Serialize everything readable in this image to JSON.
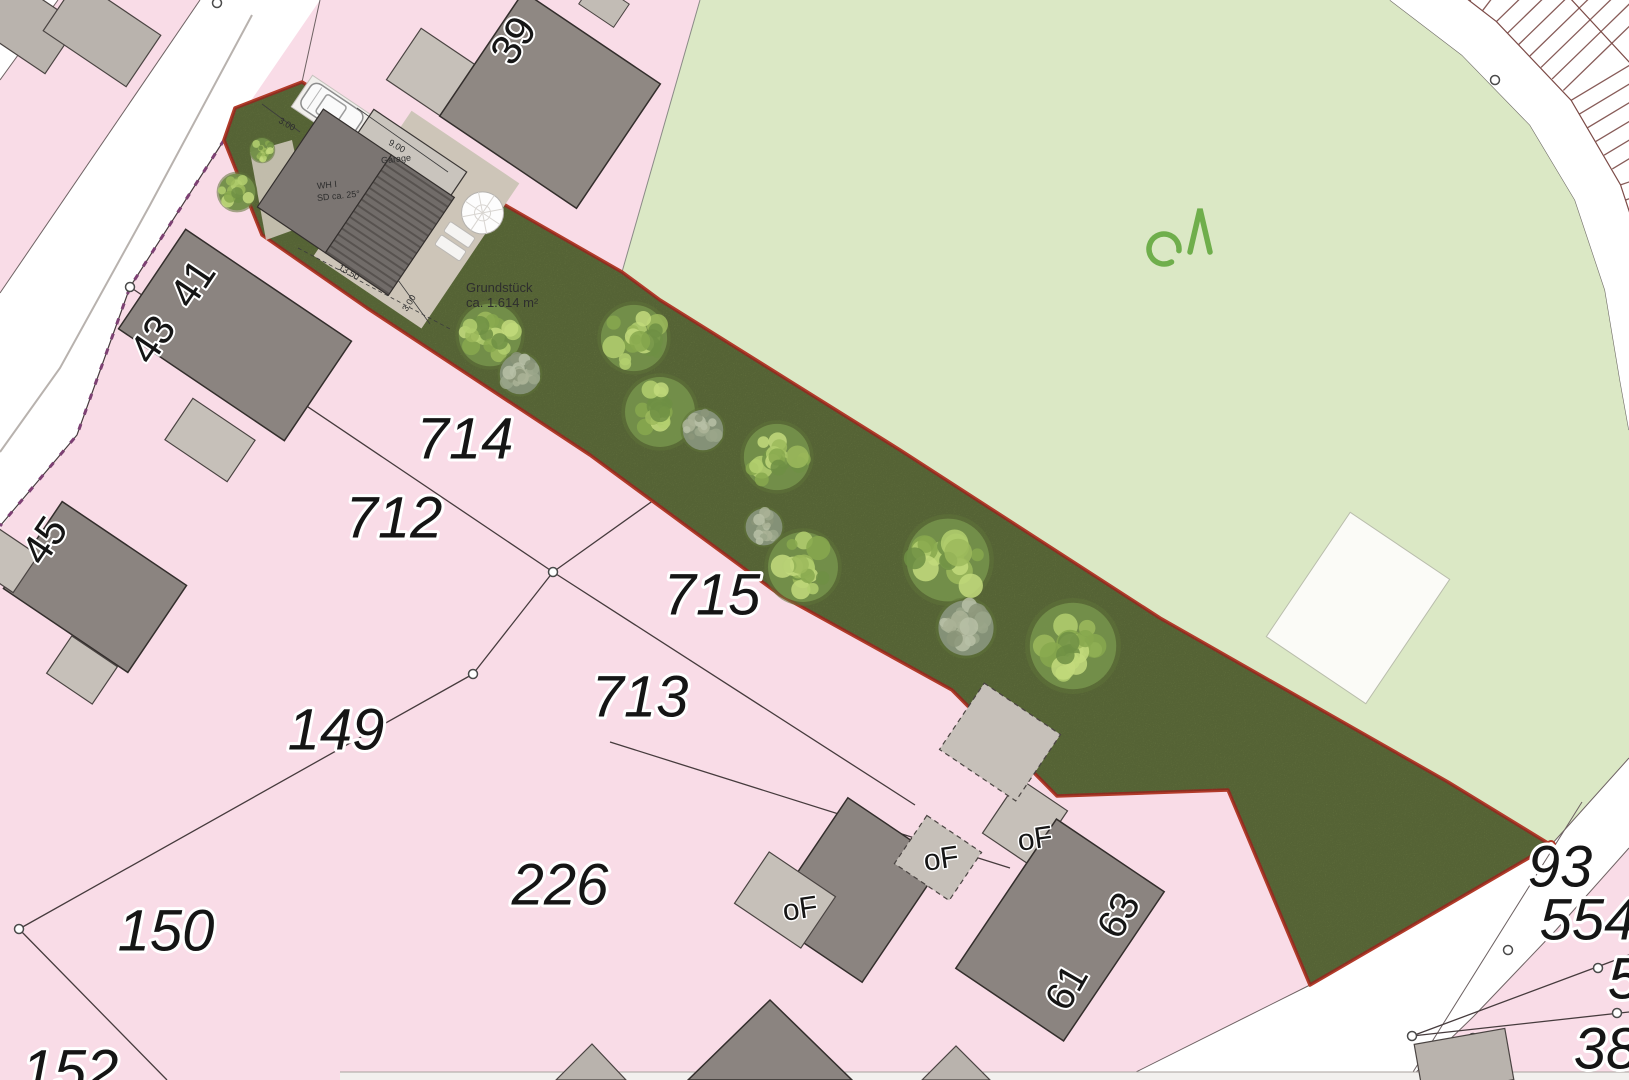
{
  "map": {
    "area_label": {
      "line1": "Grundstück",
      "line2": "ca. 1.614 m²"
    },
    "house_plan": {
      "name": "WH I",
      "roof": "SD ca. 25°",
      "garage": "Garage",
      "dim_garage": "9.00",
      "dim_house": "13.50",
      "dim_parking": "3.00",
      "dim_side": "3.00"
    },
    "vegetation_symbol": "oΛ",
    "labels": [
      {
        "t": "714",
        "x": 465,
        "y": 438,
        "s": 58,
        "r": 0,
        "cls": "parcel"
      },
      {
        "t": "712",
        "x": 394,
        "y": 517,
        "s": 58,
        "r": 0,
        "cls": "parcel"
      },
      {
        "t": "715",
        "x": 712,
        "y": 594,
        "s": 58,
        "r": 0,
        "cls": "parcel"
      },
      {
        "t": "713",
        "x": 640,
        "y": 696,
        "s": 58,
        "r": 0,
        "cls": "parcel"
      },
      {
        "t": "149",
        "x": 336,
        "y": 729,
        "s": 58,
        "r": 0,
        "cls": "parcel"
      },
      {
        "t": "150",
        "x": 166,
        "y": 930,
        "s": 58,
        "r": 0,
        "cls": "parcel"
      },
      {
        "t": "226",
        "x": 560,
        "y": 884,
        "s": 58,
        "r": 0,
        "cls": "parcel"
      },
      {
        "t": "152",
        "x": 70,
        "y": 1070,
        "s": 58,
        "r": 0,
        "cls": "parcel"
      },
      {
        "t": "93",
        "x": 1560,
        "y": 866,
        "s": 58,
        "r": 0,
        "cls": "parcel"
      },
      {
        "t": "554",
        "x": 1588,
        "y": 919,
        "s": 58,
        "r": 0,
        "cls": "parcel"
      },
      {
        "t": "5",
        "x": 1624,
        "y": 978,
        "s": 58,
        "r": 0,
        "cls": "parcel"
      },
      {
        "t": "38",
        "x": 1606,
        "y": 1048,
        "s": 58,
        "r": 0,
        "cls": "parcel"
      },
      {
        "t": "39",
        "x": 513,
        "y": 40,
        "s": 42,
        "r": -56,
        "cls": "house"
      },
      {
        "t": "41",
        "x": 192,
        "y": 283,
        "s": 42,
        "r": -56,
        "cls": "house"
      },
      {
        "t": "43",
        "x": 152,
        "y": 339,
        "s": 42,
        "r": -56,
        "cls": "house"
      },
      {
        "t": "45",
        "x": 44,
        "y": 540,
        "s": 42,
        "r": -56,
        "cls": "house"
      },
      {
        "t": "61",
        "x": 1066,
        "y": 987,
        "s": 40,
        "r": -60,
        "cls": "house"
      },
      {
        "t": "63",
        "x": 1118,
        "y": 915,
        "s": 40,
        "r": -60,
        "cls": "house"
      },
      {
        "t": "oF",
        "x": 800,
        "y": 908,
        "s": 30,
        "r": -8,
        "cls": "of"
      },
      {
        "t": "oF",
        "x": 941,
        "y": 858,
        "s": 30,
        "r": -8,
        "cls": "of"
      },
      {
        "t": "oF",
        "x": 1035,
        "y": 838,
        "s": 30,
        "r": -8,
        "cls": "of"
      }
    ],
    "trees": [
      {
        "x": 237,
        "y": 192,
        "r": 20,
        "tone": "lime"
      },
      {
        "x": 262,
        "y": 150,
        "r": 13,
        "tone": "lime"
      },
      {
        "x": 490,
        "y": 335,
        "r": 34,
        "tone": "lime"
      },
      {
        "x": 520,
        "y": 374,
        "r": 22,
        "tone": "gray"
      },
      {
        "x": 634,
        "y": 338,
        "r": 36,
        "tone": "lime"
      },
      {
        "x": 660,
        "y": 412,
        "r": 38,
        "tone": "lime"
      },
      {
        "x": 703,
        "y": 430,
        "r": 22,
        "tone": "gray"
      },
      {
        "x": 777,
        "y": 457,
        "r": 36,
        "tone": "lime"
      },
      {
        "x": 764,
        "y": 527,
        "r": 20,
        "tone": "gray"
      },
      {
        "x": 803,
        "y": 567,
        "r": 38,
        "tone": "lime"
      },
      {
        "x": 948,
        "y": 560,
        "r": 45,
        "tone": "lime"
      },
      {
        "x": 966,
        "y": 628,
        "r": 30,
        "tone": "gray"
      },
      {
        "x": 1073,
        "y": 646,
        "r": 47,
        "tone": "lime"
      }
    ],
    "colors": {
      "residential_pink": "#f9dce7",
      "public_green": "#dbe8c5",
      "plot_green": "#6e7f45",
      "plot_outline_red": "#b23b2a",
      "road_white": "#ffffff",
      "building_dark": "#8b8480",
      "building_light": "#c6c0b9",
      "parcel_line": "#463b3d",
      "parking_tick": "#7b4a46",
      "boundary_purple": "#7d4073",
      "symbol_green": "#6fae4c"
    }
  }
}
